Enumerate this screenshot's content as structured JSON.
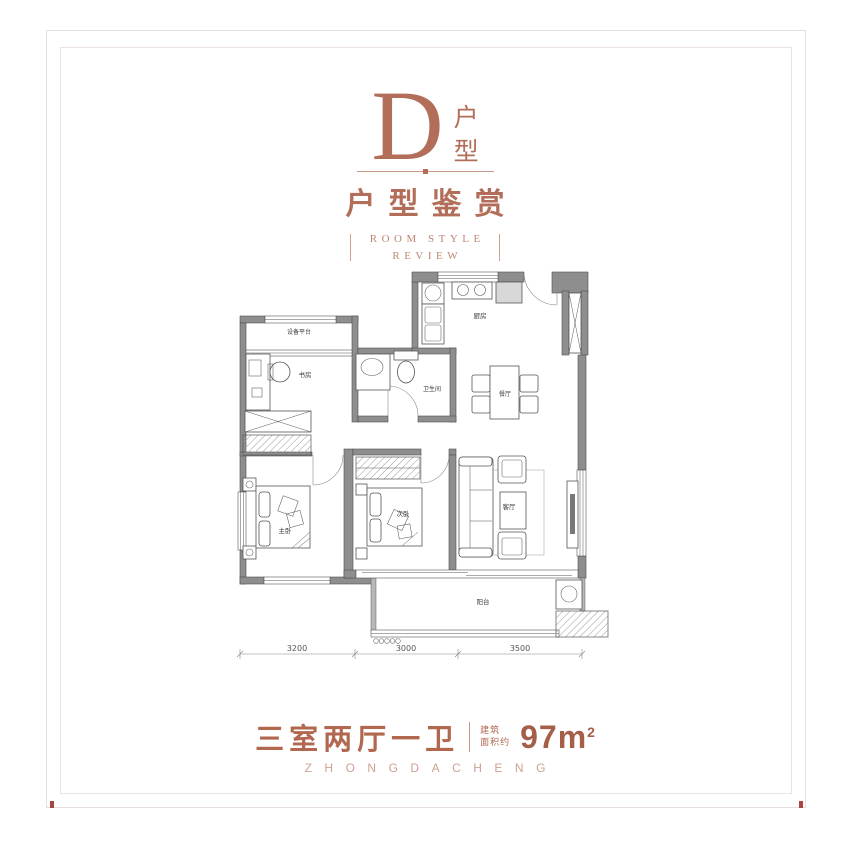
{
  "page": {
    "accent_color": "#b26e58",
    "border_color": "#e8dedb",
    "registration_mark_color": "#a94442"
  },
  "header": {
    "unit_letter": "D",
    "unit_suffix": [
      "户",
      "型"
    ],
    "title": "户型鉴赏",
    "subtitle_line1": "ROOM STYLE",
    "subtitle_line2": "REVIEW"
  },
  "plan": {
    "labels": {
      "equipment_platform": "设备平台",
      "study": "书房",
      "kitchen": "厨房",
      "bathroom": "卫生间",
      "dining": "餐厅",
      "master_bedroom": "主卧",
      "second_bedroom": "次卧",
      "living_room": "客厅",
      "balcony": "阳台"
    },
    "dims": {
      "left": "3200",
      "middle": "3000",
      "right": "3500"
    }
  },
  "footer": {
    "layout_text": "三室两厅一卫",
    "area_label_top": "建筑",
    "area_label_bottom": "面积约",
    "area_value": "97m",
    "area_sup": "2",
    "brand": "ZHONGDACHENG"
  }
}
